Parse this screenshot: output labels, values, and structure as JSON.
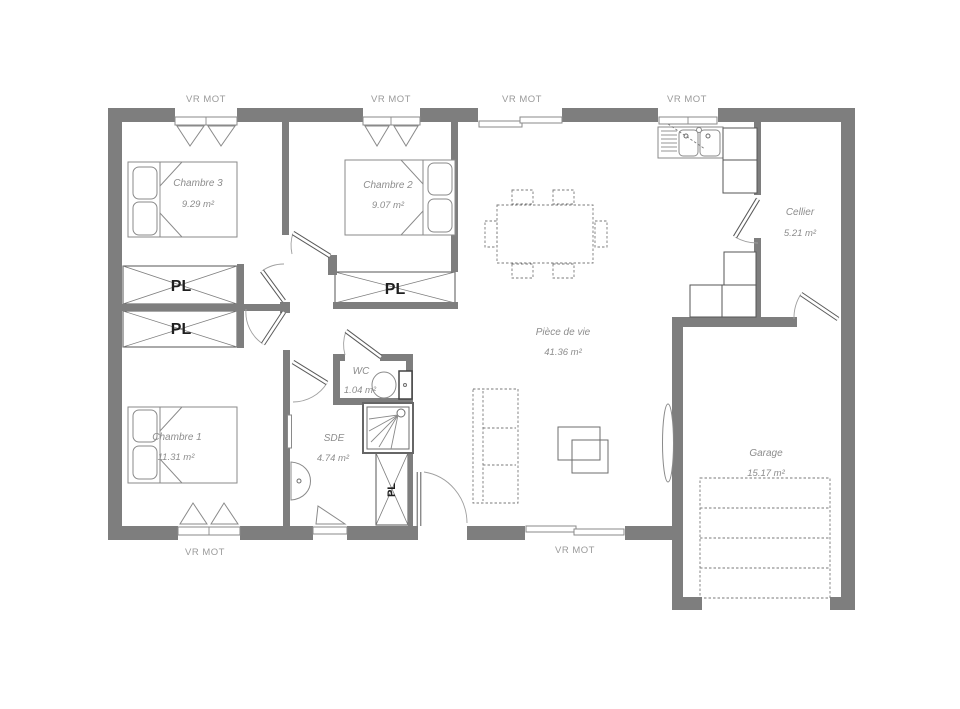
{
  "labels": {
    "vr_mot": "VR MOT",
    "closet": "PL"
  },
  "rooms": {
    "chambre3": {
      "name": "Chambre 3",
      "area": "9.29 m²"
    },
    "chambre2": {
      "name": "Chambre 2",
      "area": "9.07 m²"
    },
    "chambre1": {
      "name": "Chambre 1",
      "area": "11.31 m²"
    },
    "wc": {
      "name": "WC",
      "area": "1.04 m²"
    },
    "sde": {
      "name": "SDE",
      "area": "4.74 m²"
    },
    "piece_de_vie": {
      "name": "Pièce de vie",
      "area": "41.36 m²"
    },
    "cellier": {
      "name": "Cellier",
      "area": "5.21 m²"
    },
    "garage": {
      "name": "Garage",
      "area": "15.17 m²"
    }
  },
  "colors": {
    "wall": "#7e7e7e",
    "fixture": "#8a8a8a",
    "text": "#8d8d8d",
    "closet_text": "#1f1f1f",
    "background": "#ffffff"
  }
}
